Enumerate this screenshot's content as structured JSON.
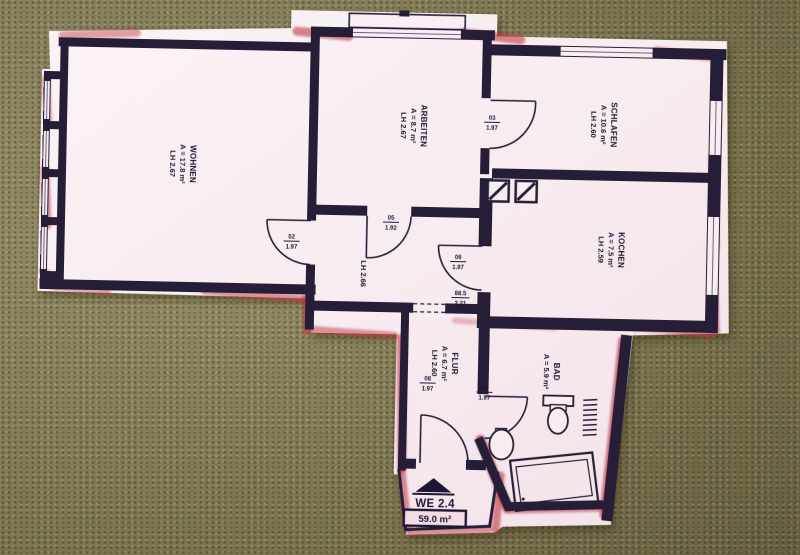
{
  "scene": {
    "description": "hand-highlighted floor plan cutout lying on olive carpet",
    "colors": {
      "paper": "#f8eef2",
      "wall": "#251e36",
      "highlight_red": "#c03543",
      "carpet": "#8f865c"
    }
  },
  "rooms": [
    {
      "name": "WOHNEN",
      "area": "A = 17.8 m²",
      "clear_height": "LH 2.67"
    },
    {
      "name": "ARBEITEN",
      "area": "A = 8.7 m²",
      "clear_height": "LH 2.67"
    },
    {
      "name": "SCHLAFEN",
      "area": "A = 10.6 m²",
      "clear_height": "LH 2.60"
    },
    {
      "name": "KOCHEN",
      "area": "A = 7.5 m²",
      "clear_height": "LH 2.59"
    },
    {
      "name": "FLUR",
      "area": "A = 6.7 m²",
      "clear_height": "LH 2.60"
    },
    {
      "name": "BAD",
      "area": "A = 5.9 m²",
      "clear_height": ""
    }
  ],
  "hall": {
    "clear_height": "LH 2.66"
  },
  "doors": [
    {
      "no": "02",
      "height": "1.97"
    },
    {
      "no": "03",
      "height": "1.97"
    },
    {
      "no": "05",
      "height": "1.92"
    },
    {
      "no": "06",
      "height": "1.97"
    },
    {
      "no": "88.5",
      "height": "2.21"
    },
    {
      "no": "08",
      "height": "1.97"
    },
    {
      "no": "09",
      "height": "1.97"
    }
  ],
  "unit": {
    "label": "WE 2.4",
    "total_area": "59.0 m²"
  }
}
